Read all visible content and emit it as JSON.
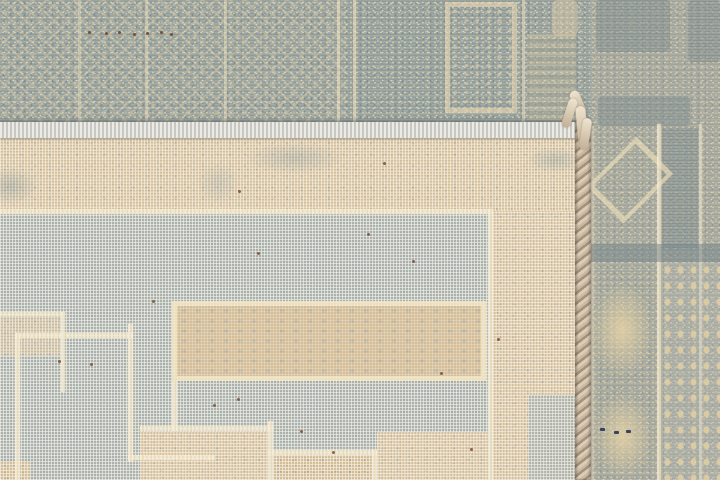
{
  "meta": {
    "description": "Close-up photograph of a hand-knotted wool rug whose lower half is folded back to reveal the reverse of the weave. The back shows a fine knot grid in muted blue-gray and beige with a cream Greek-key meander pattern; the front pile is visible along the top edge and right side, with a braided selvage edge and a small corner tassel.",
    "alt": "Back of a gray and beige hand-knotted rug folded over its front pile, with braided selvage and corner tassel"
  },
  "palette": {
    "front_gray": "#9aa5a2",
    "front_cream": "#dfcba4",
    "back_gray": "#a9b2ae",
    "back_beige": "#d4bd97",
    "cream_line": "#eedfbc",
    "binding_gray": "#d9d8d3",
    "selvage_light": "#dbcdb8",
    "selvage_dark": "#a4917a",
    "speck_brown": "#7b4f35",
    "speck_navy": "#36455c",
    "grid_white": "#f4f1e8"
  },
  "regions": {
    "scene": {
      "label": "rug photo close-up"
    },
    "front_pile_top": {
      "label": "rug front pile, top edge"
    },
    "front_pile_right": {
      "label": "rug front pile, right border bands"
    },
    "fold_binding": {
      "label": "fold line with gray edge binding strip"
    },
    "back_weave": {
      "label": "back of rug showing knot grid"
    },
    "beige_border_band": {
      "label": "beige border band on rug back"
    },
    "meander_pattern": {
      "label": "cream Greek-key meander lines"
    },
    "center_beige_bar": {
      "label": "central beige ornament bar"
    },
    "selvage_braid": {
      "label": "braided selvage edge"
    },
    "corner_tassel": {
      "label": "corner tassel"
    },
    "dot_border_band": {
      "label": "dotted guard border"
    },
    "diamond_motif": {
      "label": "diamond medallion motif"
    }
  }
}
